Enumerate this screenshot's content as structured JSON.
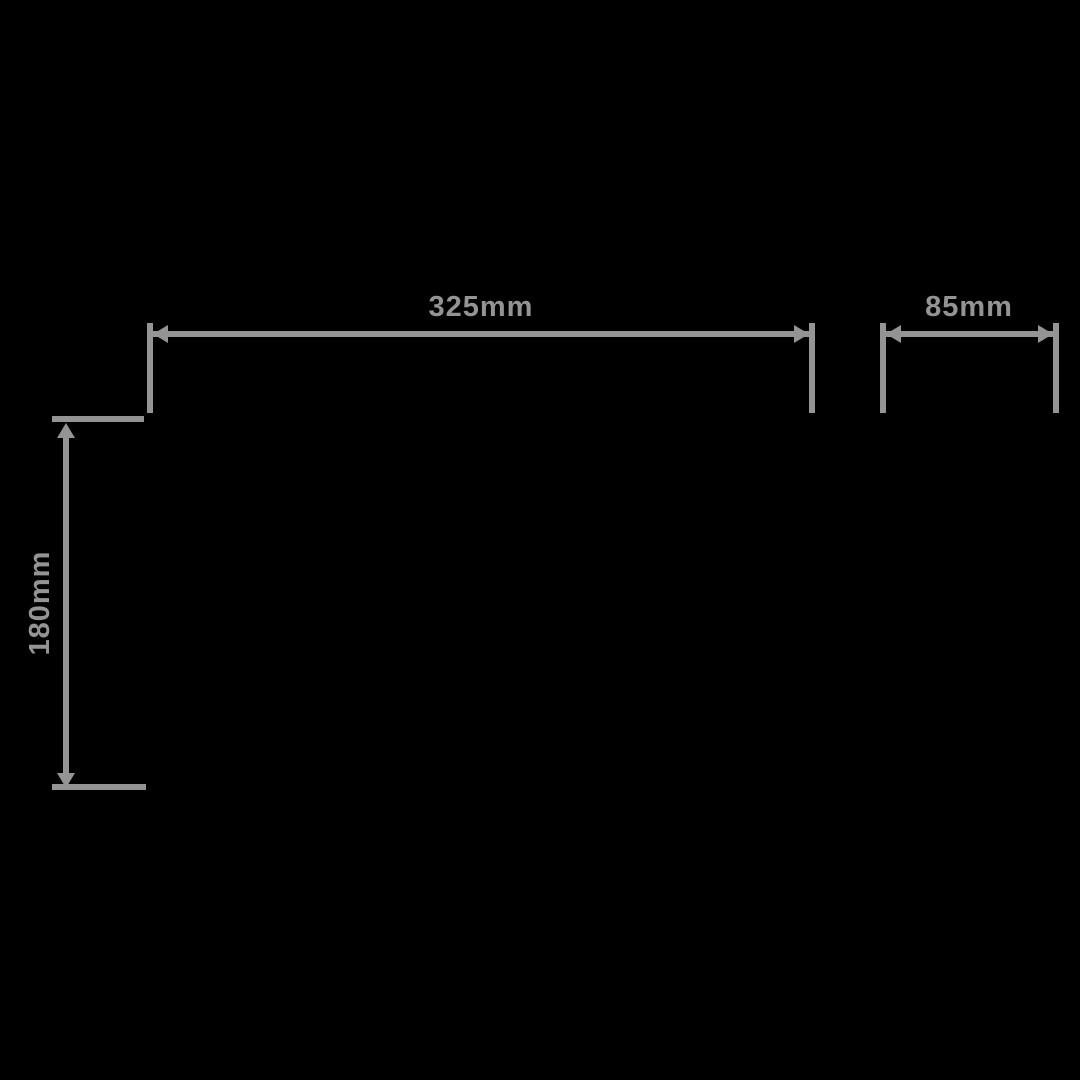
{
  "canvas": {
    "background": "#000000",
    "annotation_color": "#949494"
  },
  "drawing": {
    "type": "dimensioned-technical-drawing",
    "dimensions": [
      {
        "id": "width-main",
        "label": "325mm",
        "orientation": "horizontal"
      },
      {
        "id": "width-side",
        "label": "85mm",
        "orientation": "horizontal"
      },
      {
        "id": "height-main",
        "label": "180mm",
        "orientation": "vertical"
      }
    ]
  }
}
